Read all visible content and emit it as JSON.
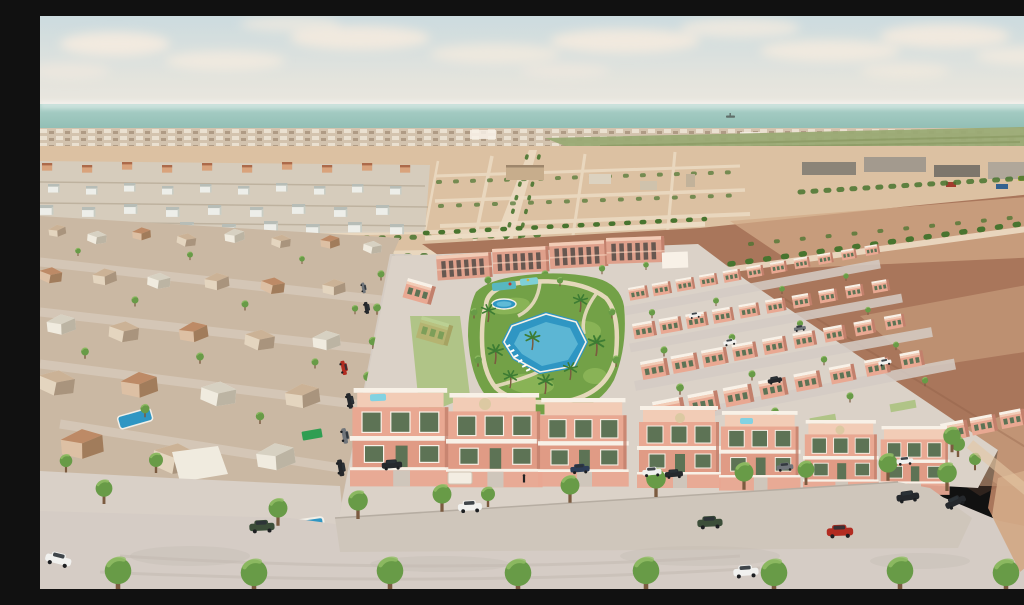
{
  "meta": {
    "type": "3d-architectural-render",
    "title": "Aerial 3D render of a coastal villa development",
    "description": "Aerial 3D visualisation of a new residential development: rows of salmon-pink two-storey villas with white-railed roof terraces and green shutters arranged around a communal landscaped garden with a large lagoon swimming pool, a children's pool and palm trees. Apartment blocks close the site to the north. To the left lies an existing beige neighbourhood with private pools, to the right empty brown building plots with a tree-lined track, farm fields and warehouses in the distance, and the sea on the horizon under a hazy sky with clouds. A foreground street with pavement trees and parked cars (white, dark green, black and red) runs along the development."
  },
  "labels": {
    "development": "new villa development",
    "central_park": "communal garden with pools",
    "main_pool": "lagoon swimming pool",
    "kids_pool": "children's pool",
    "apartments": "apartment blocks",
    "old_town": "existing neighbourhood",
    "desert_plots": "undeveloped plots",
    "dirt_field": "empty brown field",
    "sea": "sea on horizon",
    "street": "foreground street with parked cars"
  },
  "colors": {
    "sky_top": "#ccdbdf",
    "sky_mid": "#e4e4dd",
    "sky_low": "#f1e9e0",
    "cloud": "#f7ecdf",
    "sea_top": "#abd0c8",
    "sea_deep": "#8fbcb2",
    "ship": "#5a6662",
    "town_base": "#d3c3ae",
    "town_light": "#ece3d4",
    "town_dark": "#ab9680",
    "field_green": "#9aaa74",
    "field_row": "#87975f",
    "orchard": "#8b9d66",
    "desert": "#dcc1a2",
    "desert_road": "#ecdcc4",
    "dirt": "#a9765b",
    "dirt_light": "#d2a987",
    "dirt_dark": "#8a5a42",
    "sand_path": "#e2c6a4",
    "road": "#d5ccc5",
    "road_dark": "#c3b9b1",
    "sidewalk": "#cfc6bb",
    "ground": "#d9d0c7",
    "villa_wall": "#e9a892",
    "villa_wall2": "#e09b85",
    "villa_roof": "#f2ccb6",
    "villa_shadow": "#c2806c",
    "apt_wall": "#dfa08b",
    "white_wall": "#f8f1e7",
    "window_green": "#5d7355",
    "window_dark": "#514b46",
    "park_green": "#73a147",
    "lawn_light": "#93bb5d",
    "path_tan": "#eadbc1",
    "pool_blue": "#2f96c3",
    "pool_light": "#82d2e2",
    "kids_teal": "#58b7c0",
    "kids_teal2": "#7fd0d6",
    "tree_green": "#689b47",
    "tree_light": "#93bf66",
    "tree_dark": "#48742f",
    "palm_green": "#3d7c33",
    "trunk": "#7b5b40",
    "old_lit": "#e4d5bf",
    "old_roof": "#cbb296",
    "old_shadow": "#9f8871",
    "oldw_lit": "#f0ebdf",
    "oldw_roof": "#d7d1c2",
    "oldw_shadow": "#b3aa99",
    "oldt_lit": "#ddc0a4",
    "oldt_roof": "#bd8a66",
    "oldt_shadow": "#97704f",
    "rw_body": "#edeee9",
    "rw_roof": "#b7bdb7",
    "rw_side": "#c8ccc3",
    "ro_body": "#d9a37c",
    "ro_roof": "#ac6a4a",
    "car_red": "#b22c21",
    "car_white": "#f1f1ef",
    "car_black": "#25282c",
    "car_green": "#3c4e39",
    "car_gray": "#70757a",
    "car_blue": "#2d3d57",
    "glass": "#2b3237",
    "umbrella": "#dcc9a2",
    "kiosk": "#f3ede2",
    "bin_blue": "#2e4f86",
    "tarp_green": "#2f9e52"
  }
}
